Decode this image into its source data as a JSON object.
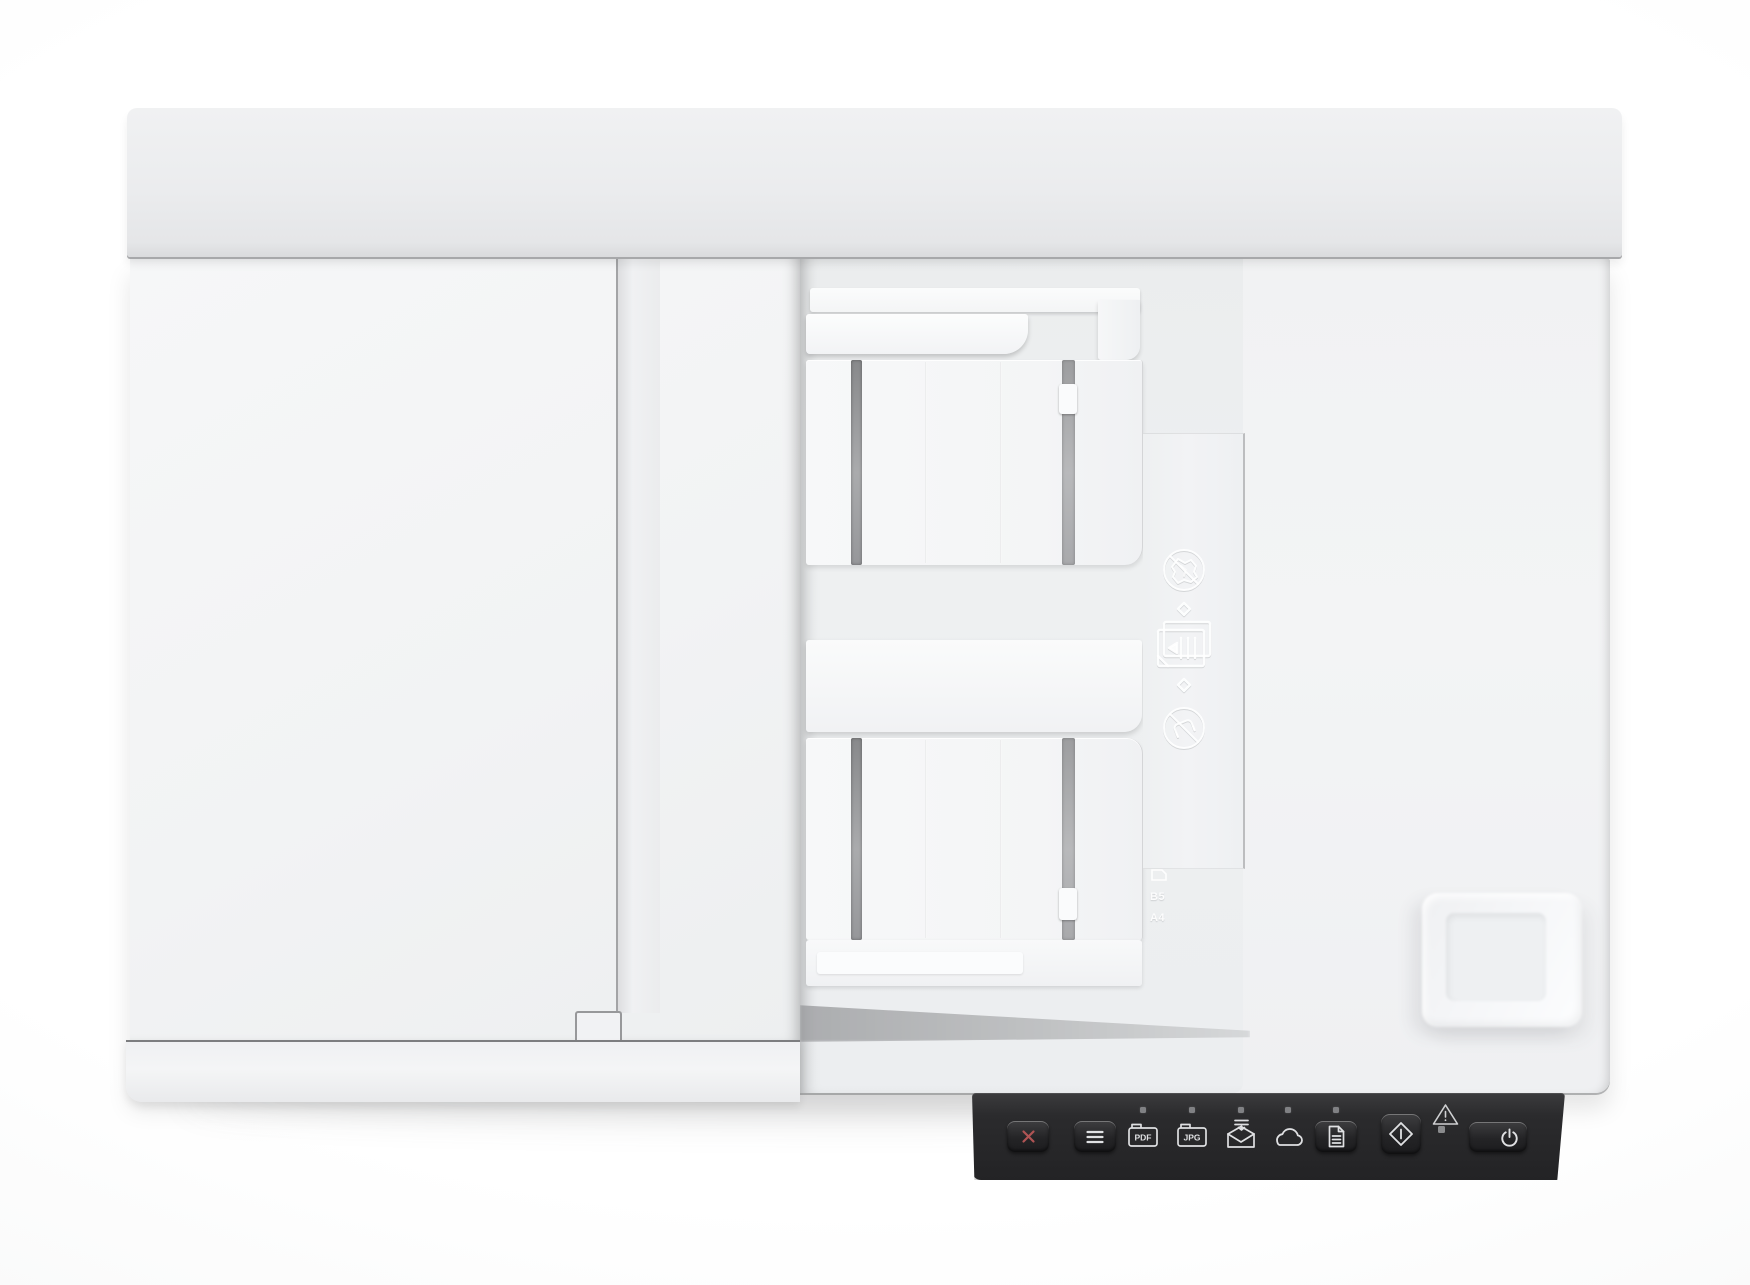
{
  "scene": {
    "type": "product-photo",
    "subject": "Top-down view of a white flatbed document scanner with automatic document feeder and dark control panel strip",
    "background_color": "#fbfcfc"
  },
  "device": {
    "body_color": "#f2f3f4",
    "bay_color": "#edeff0",
    "panel_color": "#2a2a2c",
    "cancel_accent": "#b05454"
  },
  "adf": {
    "embossed_icons": [
      "no-crumpled-paper-icon",
      "load-documents-icon",
      "feed-arrow-up-icon",
      "feed-arrow-down-icon",
      "no-staples-icon"
    ],
    "size_marks": [
      "B5",
      "A4"
    ]
  },
  "control_panel": {
    "function_led_count": 5,
    "buttons": [
      {
        "id": "cancel",
        "icon": "x-cancel-icon"
      },
      {
        "id": "menu",
        "icon": "menu-icon"
      },
      {
        "id": "scan-to-pdf",
        "icon": "pdf-icon",
        "label": "PDF",
        "has_led": true
      },
      {
        "id": "scan-to-jpg",
        "icon": "jpg-icon",
        "label": "JPG",
        "has_led": true
      },
      {
        "id": "scan-to-email",
        "icon": "email-icon",
        "has_led": true
      },
      {
        "id": "scan-to-cloud",
        "icon": "cloud-icon",
        "has_led": true
      },
      {
        "id": "copy",
        "icon": "document-copy-icon",
        "has_led": true
      },
      {
        "id": "start-scan",
        "icon": "start-diamond-icon"
      },
      {
        "id": "power",
        "icon": "power-icon"
      }
    ],
    "indicators": [
      {
        "id": "warning",
        "icon": "warning-triangle-icon"
      },
      {
        "id": "error-led"
      }
    ]
  }
}
